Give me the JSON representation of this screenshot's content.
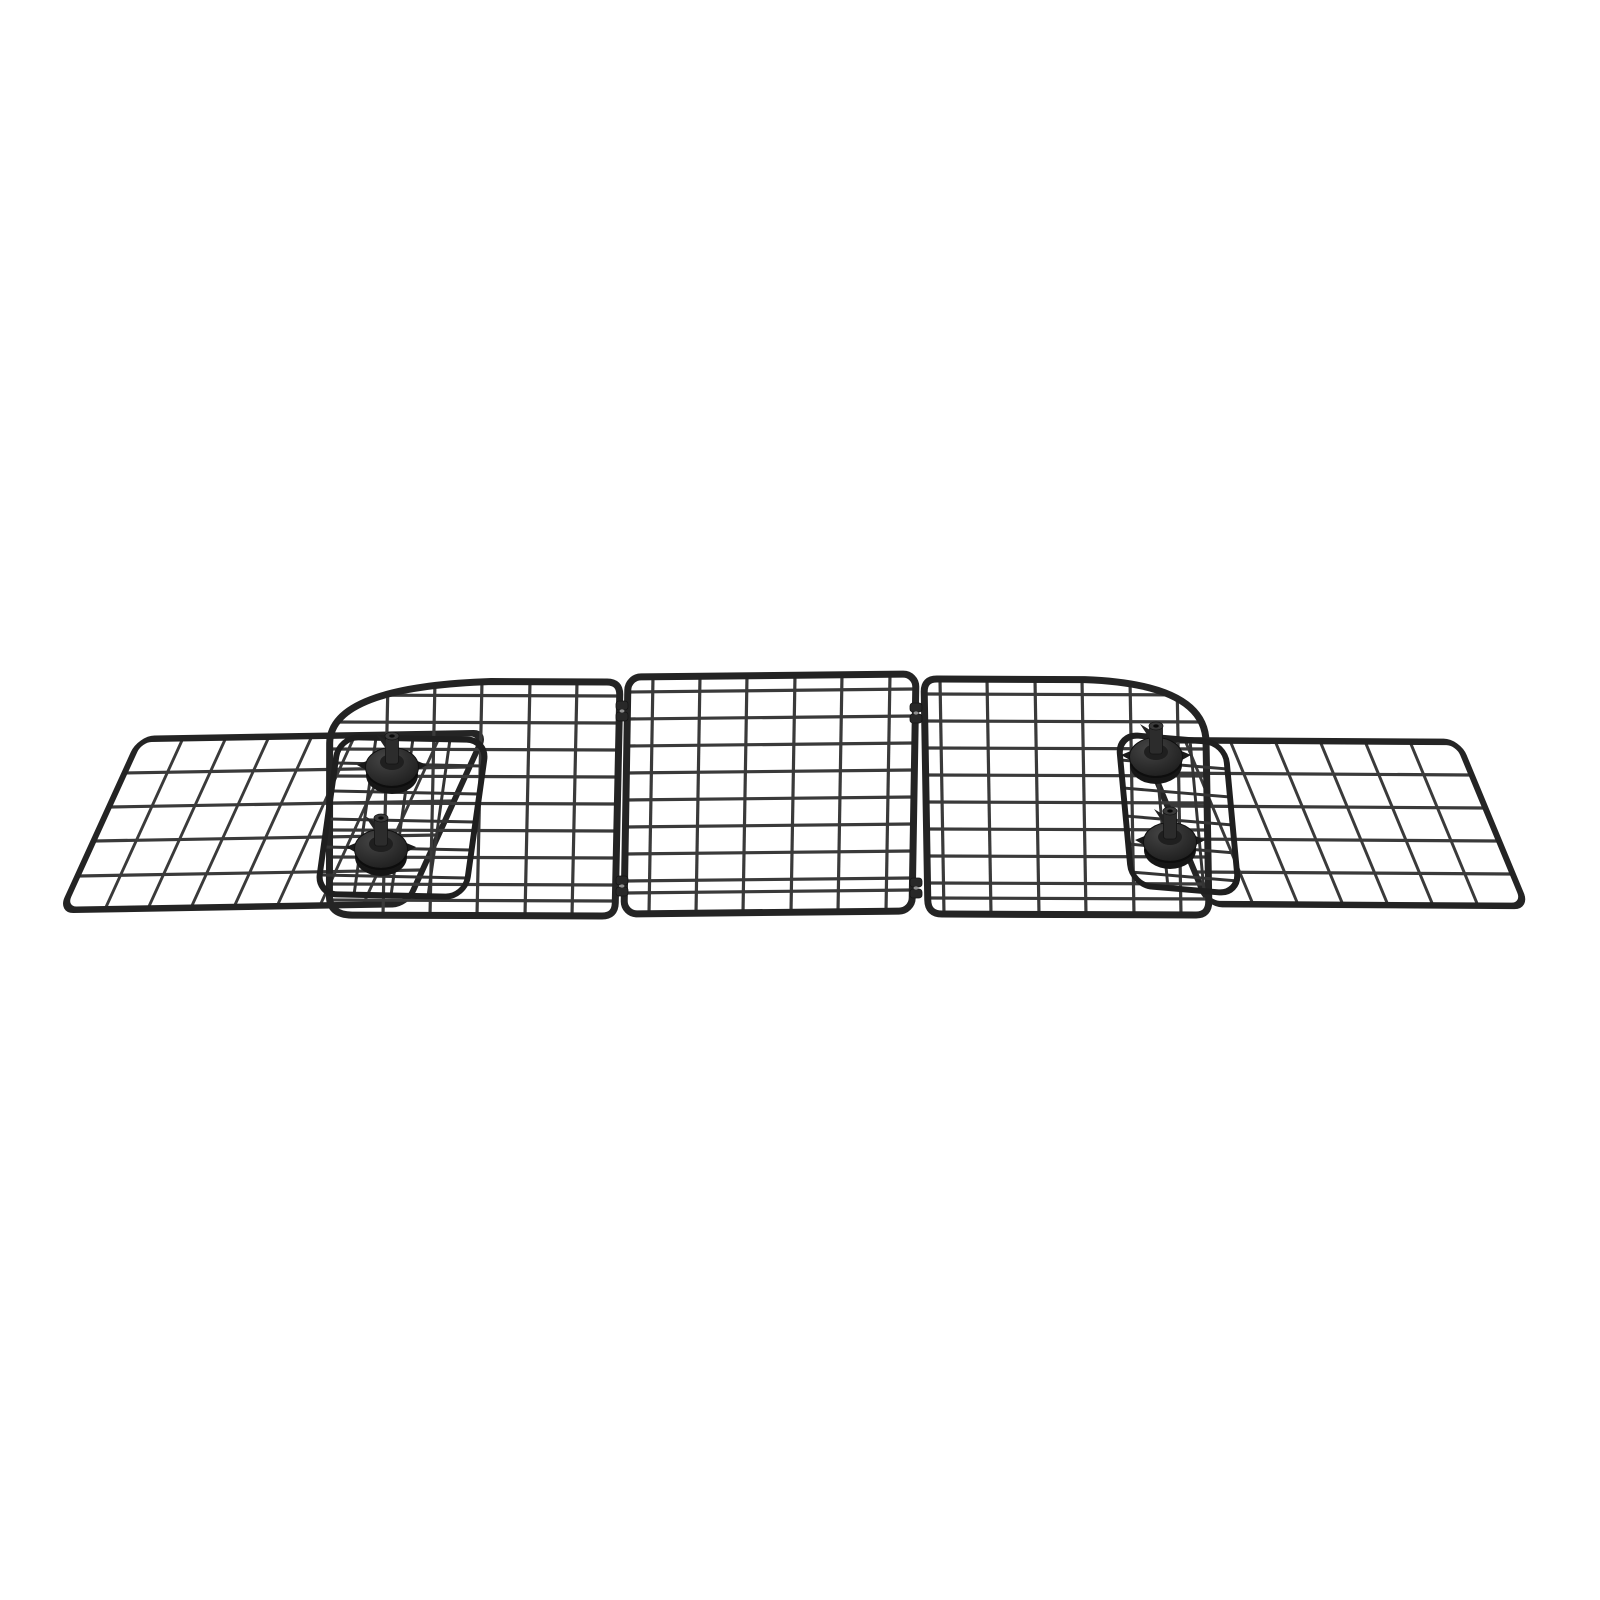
{
  "scene": {
    "type": "product-photo",
    "description": "Adjustable black wire-mesh vehicle pet barrier: three hinged mesh panels, two sliding side extension wing panels, two clamp brackets and four round locking knobs, on a plain white background",
    "background_color": "#ffffff"
  },
  "colors": {
    "background": "#ffffff",
    "frame": "#242424",
    "wire": "#3a3a3a",
    "bracket_frame": "#1f1f1f",
    "bracket_wire": "#343434",
    "knob_body": "#2e2e2e",
    "knob_dark": "#161616",
    "knob_cap": "#3a3a3a",
    "knob_hole": "#0a0a0a",
    "hinge": "#282828",
    "hinge_highlight": "#909090"
  },
  "parts": {
    "panels": [
      {
        "id": "left-extension-wing-panel",
        "label": "left extension wing panel"
      },
      {
        "id": "right-extension-wing-panel",
        "label": "right extension wing panel"
      },
      {
        "id": "left-main-panel",
        "label": "left main mesh panel"
      },
      {
        "id": "center-panel",
        "label": "center mesh panel"
      },
      {
        "id": "right-main-panel",
        "label": "right main mesh panel"
      },
      {
        "id": "left-slide-bracket",
        "label": "left sliding clamp bracket"
      },
      {
        "id": "right-slide-bracket",
        "label": "right sliding clamp bracket"
      }
    ],
    "knobs": {
      "count": 4,
      "label": "locking knob"
    },
    "hinges": {
      "count": 4,
      "label": "hinge"
    }
  }
}
